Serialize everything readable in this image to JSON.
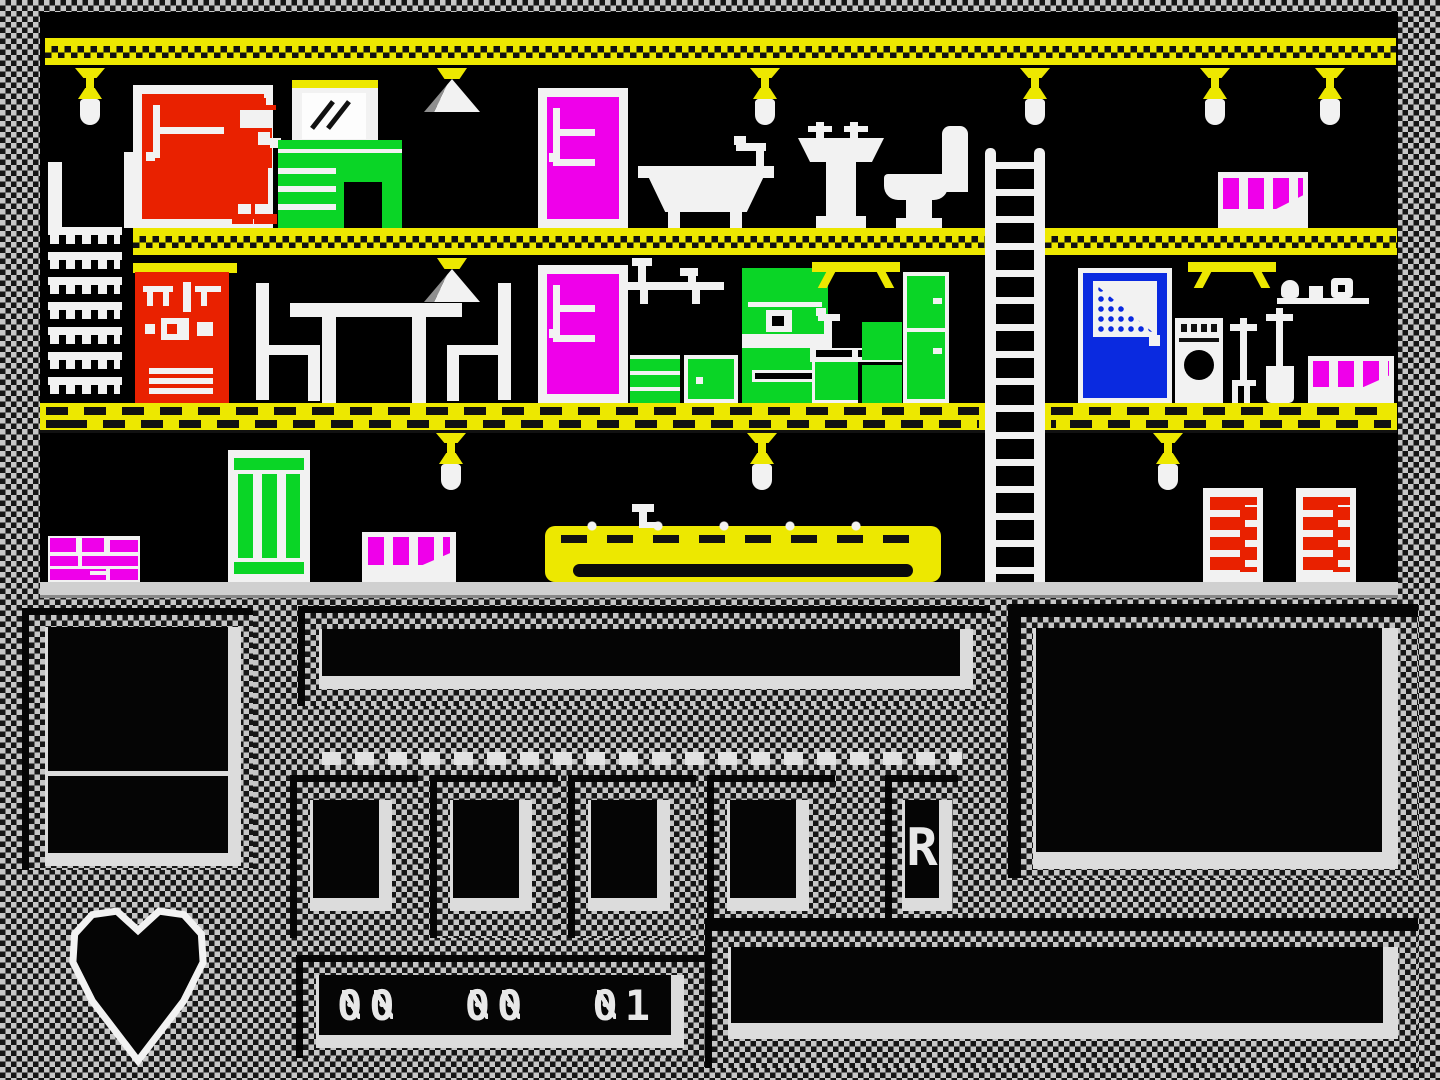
{
  "palette": {
    "black": "#000000",
    "white": "#f2f2f2",
    "yellow": "#ede800",
    "red": "#e92100",
    "magenta": "#ef00ea",
    "green": "#0ad526",
    "blue": "#0a2ae0",
    "hud_checker_light": "#c6c6c6",
    "hud_checker_dark": "#161616"
  },
  "hud": {
    "score_display": {
      "groups": [
        "00",
        "00",
        "01"
      ]
    },
    "slot_indicator": "R",
    "energy_icon": "heart-icon",
    "inventory_slot_count": 4
  },
  "scene": {
    "floors": 3,
    "sprites": [
      "red-door",
      "wally",
      "wall-mirror",
      "green-dresser",
      "ceiling-lamp",
      "triangle-lamp",
      "magenta-door",
      "bathtub",
      "wash-basin",
      "toilet",
      "magenta-key-radiator",
      "ladder",
      "comb-stairs",
      "red-shelf-unit",
      "dining-table",
      "dining-chair",
      "kitchen-drawers",
      "kitchen-cupboard",
      "kitchen-cooker",
      "kitchen-sink",
      "green-fridge",
      "wall-shelf-items",
      "blue-door",
      "washing-machine",
      "garden-fork",
      "garden-spade",
      "magenta-bricks",
      "green-radiator",
      "yellow-sofa",
      "red-column-radiator",
      "yellow-wall-table"
    ]
  }
}
